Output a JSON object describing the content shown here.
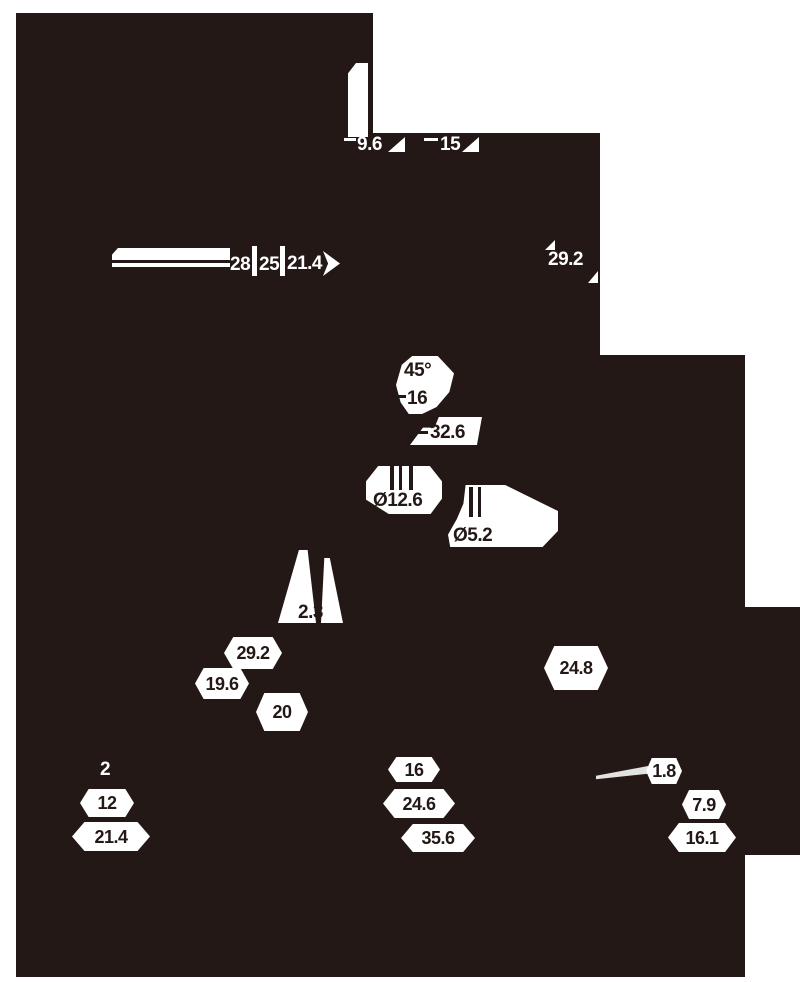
{
  "drawing": {
    "type": "technical-dimension-drawing",
    "colors": {
      "background": "#ffffff",
      "ink": "#231815",
      "annotation": "#ffffff",
      "leader_line": "#e2e2e0"
    },
    "labels": {
      "d9_6": "9.6",
      "d15": "15",
      "d28": "28",
      "d25": "25",
      "d21_4_top": "21.4",
      "d29_2_right": "29.2",
      "d45deg": "45°",
      "d16_top": "16",
      "d32_6": "32.6",
      "dia12_6": "Ø12.6",
      "dia5_2": "Ø5.2",
      "d2_3": "2.3",
      "d29_2_left": "29.2",
      "d19_6": "19.6",
      "d20": "20",
      "d24_8": "24.8",
      "d2": "2",
      "d12": "12",
      "d21_4_bottom": "21.4",
      "d16_bottom": "16",
      "d24_6": "24.6",
      "d35_6": "35.6",
      "d1_8": "1.8",
      "d7_9": "7.9",
      "d16_1": "16.1"
    }
  }
}
